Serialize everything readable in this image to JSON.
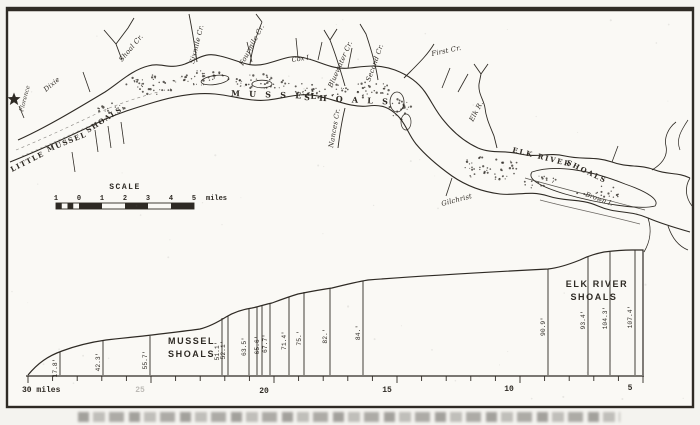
{
  "colors": {
    "paper": "#f4f3ef",
    "ink": "#2e2a24",
    "faint": "#6b675f"
  },
  "map": {
    "star_town": "Florence",
    "labels": {
      "dixie": "Dixie",
      "little_1": "LITTLE",
      "little_2": "MUSSEL",
      "little_3": "SHOALS",
      "big_1": "M U S S E L",
      "big_2": "S H O A L S",
      "cox_island": "Cox I.",
      "elk_1": "ELK RIVER",
      "elk_2": "SHOALS",
      "gilchrist": "Gilchrist",
      "brown_island": "Brown I."
    },
    "creeks": [
      {
        "name": "Shoal Cr."
      },
      {
        "name": "Sixmile Cr."
      },
      {
        "name": "Fourmile Cr."
      },
      {
        "name": "Bluewater Cr."
      },
      {
        "name": "Second Cr."
      },
      {
        "name": "First Cr."
      },
      {
        "name": "Nances Cr."
      },
      {
        "name": "Elk R."
      }
    ]
  },
  "scale_bar": {
    "title": "SCALE",
    "tick_labels": [
      "1",
      "0",
      "1",
      "2",
      "3",
      "4",
      "5"
    ],
    "unit": "miles"
  },
  "chart_data": {
    "type": "line",
    "title": "",
    "xlabel": "miles",
    "x_axis_labels": [
      "30 miles",
      "25",
      "20",
      "15",
      "10",
      "5"
    ],
    "x_range_miles": [
      30,
      5
    ],
    "grid": false,
    "section_labels": [
      {
        "line1": "MUSSEL",
        "line2": "SHOALS"
      },
      {
        "line1": "ELK RIVER",
        "line2": "SHOALS"
      }
    ],
    "points": [
      {
        "mile": 28.7,
        "label": "17.8'"
      },
      {
        "mile": 26.9,
        "label": "42.3'"
      },
      {
        "mile": 25.0,
        "label": "55.7'"
      },
      {
        "mile": 21.6,
        "label": "51.1'"
      },
      {
        "mile": 21.4,
        "label": "52.1'"
      },
      {
        "mile": 20.5,
        "label": "63.5'"
      },
      {
        "mile": 20.0,
        "label": "65.6'"
      },
      {
        "mile": 19.7,
        "label": "67.7'"
      },
      {
        "mile": 18.9,
        "label": "71.4'"
      },
      {
        "mile": 18.3,
        "label": "75.'"
      },
      {
        "mile": 17.2,
        "label": "82.'"
      },
      {
        "mile": 15.9,
        "label": "84.'"
      },
      {
        "mile": 8.3,
        "label": "90.9'"
      },
      {
        "mile": 6.7,
        "label": "93.4'"
      },
      {
        "mile": 5.8,
        "label": "104.3'"
      },
      {
        "mile": 4.8,
        "label": "107.4'"
      }
    ]
  }
}
